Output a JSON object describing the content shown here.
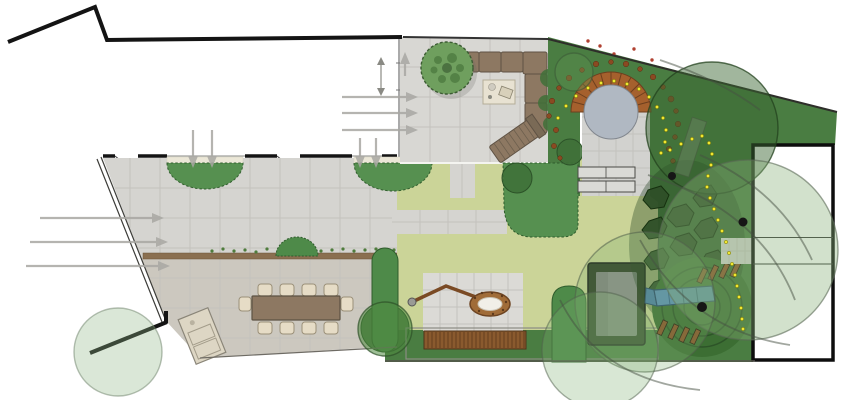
{
  "meta": {
    "type": "landscape-garden-plan",
    "canvas_width": 843,
    "canvas_height": 400
  },
  "palette": {
    "page_bg": "#ffffff",
    "boundary_ink": "#141414",
    "fence_ink": "#3c3c38",
    "paving_terrace": "#d8d7d3",
    "paving_court_upper": "#d5d4d0",
    "paving_court_lower": "#ccc8bf",
    "paving_patio": "#dbdad6",
    "paving_pad": "#d2d2cf",
    "tile_joint": "#c3c2bd",
    "cream_edge": "#ebe7d7",
    "lawn": "#cbd498",
    "planting_dark": "#4a7d42",
    "bed_green": "#569050",
    "hedge_green": "#4e8a49",
    "mound_green": "#3c6e33",
    "flagstone": "#2e4f28",
    "water": "#b0b8c2",
    "brick": "#a5602d",
    "brick_joint": "#6d3f1e",
    "wood": "#8d7862",
    "wood_dark": "#5f5244",
    "deck_wood": "#8a5a2e",
    "chair_beige": "#e6dcc6",
    "slide_blue": "#5b8fb8",
    "trampoline_frame": "#2b3a23",
    "trampoline_mat": "#8d8d8d",
    "arrow_grey": "#a8a7a2",
    "path_yellow": "#f0e832",
    "soil_dot": "#8a4a22",
    "berry_red": "#b04030",
    "speckle_green": "#4e7c3c",
    "shrub_green": "#3f7038",
    "trunk_ink": "#161616",
    "strip_wall": "#8a6f50",
    "step_grey": "#dadad6"
  },
  "plan": {
    "pond": {
      "cx": 611,
      "cy": 112,
      "r_water": 27,
      "r_outer": 40,
      "joint_count": 12
    },
    "deck": {
      "x": 424,
      "y": 331,
      "w": 102,
      "h": 18,
      "plank_px": 4
    },
    "canopies": [
      {
        "name": "canopy-large-top-right",
        "cx": 712,
        "cy": 128,
        "r": 66,
        "fill": "#3a6632",
        "opacity": 0.48,
        "stroke": "rgba(35,65,30,0.75)"
      },
      {
        "name": "canopy-over-building",
        "cx": 748,
        "cy": 250,
        "r": 90,
        "fill": "#88b078",
        "opacity": 0.38,
        "stroke": "rgba(90,105,85,0.6)"
      },
      {
        "name": "canopy-play-area",
        "cx": 645,
        "cy": 302,
        "r": 70,
        "fill": "#7fae6f",
        "opacity": 0.28,
        "stroke": "rgba(80,95,75,0.55)"
      },
      {
        "name": "canopy-bottom-center",
        "cx": 600,
        "cy": 350,
        "r": 58,
        "fill": "#7fae6f",
        "opacity": 0.3,
        "stroke": "rgba(80,95,75,0.5)"
      },
      {
        "name": "canopy-hedge-left",
        "cx": 385,
        "cy": 329,
        "r": 27,
        "fill": "#4f8a3f",
        "opacity": 0.55,
        "stroke": "rgba(45,80,40,0.7)"
      },
      {
        "name": "canopy-bottom-left",
        "cx": 118,
        "cy": 352,
        "r": 44,
        "fill": "#8fb687",
        "opacity": 0.33,
        "stroke": "rgba(110,130,105,0.5)"
      },
      {
        "name": "canopy-pond-left",
        "cx": 574,
        "cy": 72,
        "r": 19,
        "fill": "#5d8f4f",
        "opacity": 0.4,
        "stroke": "rgba(60,90,55,0.6)"
      }
    ],
    "shrubs": [
      [
        517,
        178,
        15
      ],
      [
        570,
        152,
        13
      ],
      [
        385,
        328,
        24
      ]
    ],
    "trunks": [
      [
        672,
        176,
        4
      ],
      [
        743,
        222,
        4.5
      ],
      [
        702,
        307,
        5
      ]
    ],
    "yellow_path": [
      [
        558,
        118
      ],
      [
        566,
        106
      ],
      [
        576,
        96
      ],
      [
        588,
        88
      ],
      [
        601,
        83
      ],
      [
        614,
        81
      ],
      [
        627,
        84
      ],
      [
        639,
        89
      ],
      [
        649,
        97
      ],
      [
        657,
        107
      ],
      [
        663,
        118
      ],
      [
        666,
        130
      ],
      [
        665,
        142
      ],
      [
        661,
        153
      ],
      [
        670,
        150
      ],
      [
        681,
        144
      ],
      [
        692,
        139
      ],
      [
        702,
        136
      ],
      [
        709,
        143
      ],
      [
        712,
        154
      ],
      [
        711,
        165
      ],
      [
        708,
        176
      ],
      [
        707,
        187
      ],
      [
        710,
        198
      ],
      [
        714,
        209
      ],
      [
        718,
        220
      ],
      [
        722,
        231
      ],
      [
        726,
        242
      ],
      [
        729,
        253
      ],
      [
        732,
        264
      ],
      [
        735,
        275
      ],
      [
        737,
        286
      ],
      [
        739,
        297
      ],
      [
        741,
        308
      ],
      [
        742,
        319
      ],
      [
        743,
        329
      ]
    ],
    "soil_dots": [
      [
        556,
        130,
        2.6
      ],
      [
        549,
        116,
        2.4
      ],
      [
        552,
        101,
        2.8
      ],
      [
        559,
        88,
        2.4
      ],
      [
        569,
        78,
        2.8
      ],
      [
        582,
        70,
        2.4
      ],
      [
        596,
        64,
        2.8
      ],
      [
        611,
        62,
        2.4
      ],
      [
        626,
        64,
        2.8
      ],
      [
        640,
        69,
        2.4
      ],
      [
        653,
        77,
        2.8
      ],
      [
        663,
        87,
        2.4
      ],
      [
        671,
        99,
        3.0
      ],
      [
        676,
        111,
        2.4
      ],
      [
        678,
        124,
        2.8
      ],
      [
        675,
        137,
        2.4
      ],
      [
        669,
        149,
        2.8
      ],
      [
        673,
        161,
        2.4
      ],
      [
        554,
        146,
        2.6
      ],
      [
        560,
        158,
        2.2
      ]
    ],
    "red_dots": [
      [
        614,
        54
      ],
      [
        600,
        46
      ],
      [
        634,
        49
      ],
      [
        652,
        60
      ],
      [
        588,
        41
      ]
    ],
    "strip_speckles": [
      [
        212,
        251
      ],
      [
        223,
        249
      ],
      [
        234,
        251
      ],
      [
        245,
        250
      ],
      [
        256,
        252
      ],
      [
        267,
        249
      ],
      [
        278,
        251
      ],
      [
        289,
        250
      ],
      [
        300,
        248
      ],
      [
        310,
        249
      ],
      [
        321,
        251
      ],
      [
        332,
        250
      ],
      [
        343,
        249
      ],
      [
        354,
        251
      ],
      [
        365,
        250
      ],
      [
        376,
        249
      ],
      [
        387,
        251
      ],
      [
        394,
        250
      ]
    ],
    "chairs": [
      [
        258,
        284,
        14,
        12
      ],
      [
        280,
        284,
        14,
        12
      ],
      [
        302,
        284,
        14,
        12
      ],
      [
        324,
        284,
        14,
        12
      ],
      [
        258,
        322,
        14,
        12
      ],
      [
        280,
        322,
        14,
        12
      ],
      [
        302,
        322,
        14,
        12
      ],
      [
        324,
        322,
        14,
        12
      ],
      [
        239,
        297,
        12,
        14
      ],
      [
        341,
        297,
        12,
        14
      ]
    ],
    "flagstones": [
      "648,190 661,186 669,195 664,207 651,209 643,200",
      "673,208 686,204 694,213 689,225 676,227 667,218",
      "649,221 661,217 667,226 662,237 649,239 642,230",
      "676,237 689,233 697,242 692,254 679,256 670,247",
      "651,252 663,248 669,257 664,268 651,270 644,261",
      "678,267 691,263 699,272 694,284 681,286 672,277",
      "654,282 666,278 672,287 667,298 654,300 647,291",
      "701,221 712,217 718,226 713,237 701,239 694,230",
      "700,189 711,185 717,194 712,205 700,207 693,198",
      "681,299 694,295 702,304 697,316 684,318 675,309",
      "706,254 718,250 726,259 721,271 708,273 700,264"
    ],
    "arrows": [
      {
        "name": "entry-arrow-1",
        "x1": 40,
        "y1": 218,
        "x2": 152,
        "y2": 218
      },
      {
        "name": "entry-arrow-2",
        "x1": 30,
        "y1": 242,
        "x2": 156,
        "y2": 242
      },
      {
        "name": "entry-arrow-3",
        "x1": 26,
        "y1": 266,
        "x2": 158,
        "y2": 266
      },
      {
        "name": "terrace-door-arrow-1",
        "x1": 342,
        "y1": 97,
        "x2": 406,
        "y2": 97
      },
      {
        "name": "terrace-door-arrow-2",
        "x1": 342,
        "y1": 113,
        "x2": 406,
        "y2": 113
      },
      {
        "name": "terrace-door-arrow-3",
        "x1": 342,
        "y1": 130,
        "x2": 406,
        "y2": 130
      },
      {
        "name": "window-arrow-1",
        "x1": 193,
        "y1": 130,
        "x2": 193,
        "y2": 156
      },
      {
        "name": "window-arrow-2",
        "x1": 212,
        "y1": 130,
        "x2": 212,
        "y2": 156
      },
      {
        "name": "window-arrow-3",
        "x1": 360,
        "y1": 138,
        "x2": 360,
        "y2": 156
      },
      {
        "name": "window-arrow-4",
        "x1": 376,
        "y1": 138,
        "x2": 376,
        "y2": 156
      },
      {
        "name": "terrace-up-arrow",
        "x1": 405,
        "y1": 76,
        "x2": 405,
        "y2": 64
      }
    ]
  }
}
